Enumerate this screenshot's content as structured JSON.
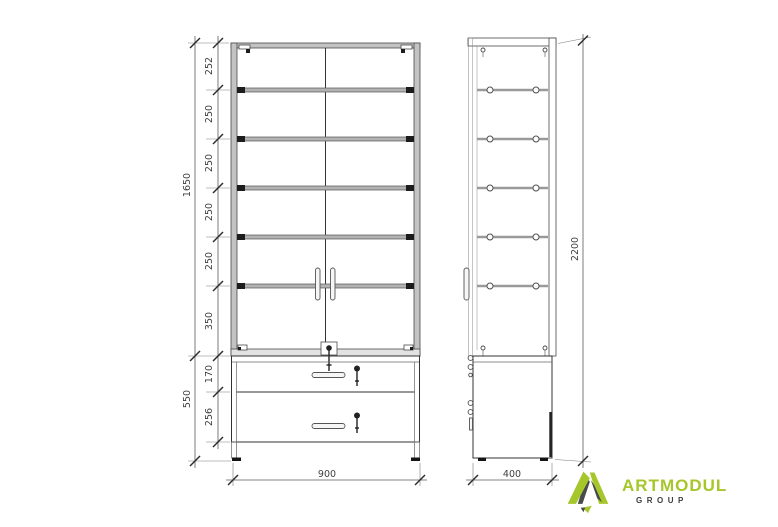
{
  "drawing": {
    "description": "Technical dimension drawing of a glass showcase cabinet with drawer base, front view and side view",
    "front_view": {
      "shelf_segments": [
        "252",
        "250",
        "250",
        "250",
        "250",
        "350"
      ],
      "glass_section_height": "1650",
      "base_segments": [
        "170",
        "256"
      ],
      "base_height": "550",
      "width": "900"
    },
    "side_view": {
      "depth": "400",
      "total_height": "2200"
    }
  },
  "logo": {
    "name": "ARTMODUL",
    "subtitle": "GROUP",
    "brand_color": "#a6c72b",
    "dark_color": "#3d3d3d"
  }
}
